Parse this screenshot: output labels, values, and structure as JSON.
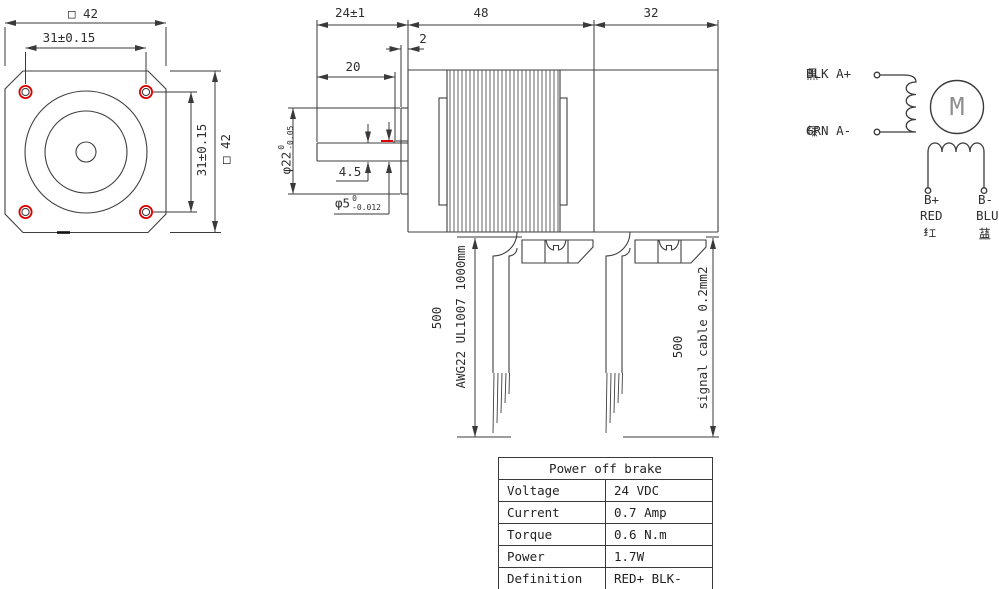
{
  "front_view": {
    "dim_width": "□ 42",
    "dim_hole_spacing_h": "31±0.15",
    "dim_hole_spacing_v": "31±0.15",
    "dim_height": "□ 42"
  },
  "side_view": {
    "dim_shaft_length": "24±1",
    "dim_pilot_depth": "2",
    "dim_flat_length": "20",
    "dim_body_length": "48",
    "dim_brake_length": "32",
    "dim_flat_height": "4.5",
    "dim_pilot_dia": {
      "base": "φ22",
      "tol_upper": "0",
      "tol_lower": "-0.05"
    },
    "dim_shaft_dia": {
      "base": "φ5",
      "tol_upper": "0",
      "tol_lower": "-0.012"
    }
  },
  "cables": {
    "left": {
      "length": "500",
      "spec": "AWG22 UL1007 1000mm"
    },
    "right": {
      "length": "500",
      "spec": "signal cable 0.2mm2"
    }
  },
  "wiring": {
    "phase_a_pos": {
      "cn": "黑",
      "label": "BLK A+"
    },
    "phase_a_neg": {
      "cn": "绿",
      "label": "GRN A-"
    },
    "motor_label": "M",
    "phase_b_pos": {
      "terminal": "B+",
      "color": "RED",
      "cn": "红"
    },
    "phase_b_neg": {
      "terminal": "B-",
      "color": "BLU",
      "cn": "蓝"
    }
  },
  "brake_table": {
    "title": "Power off brake",
    "rows": [
      {
        "param": "Voltage",
        "value": "24 VDC"
      },
      {
        "param": "Current",
        "value": "0.7 Amp"
      },
      {
        "param": "Torque",
        "value": "0.6 N.m"
      },
      {
        "param": "Power",
        "value": "1.7W"
      },
      {
        "param": "Definition",
        "value": "RED+ BLK-"
      }
    ]
  },
  "colors": {
    "line": "#3a3a3a",
    "accent_red": "#dd0000"
  }
}
